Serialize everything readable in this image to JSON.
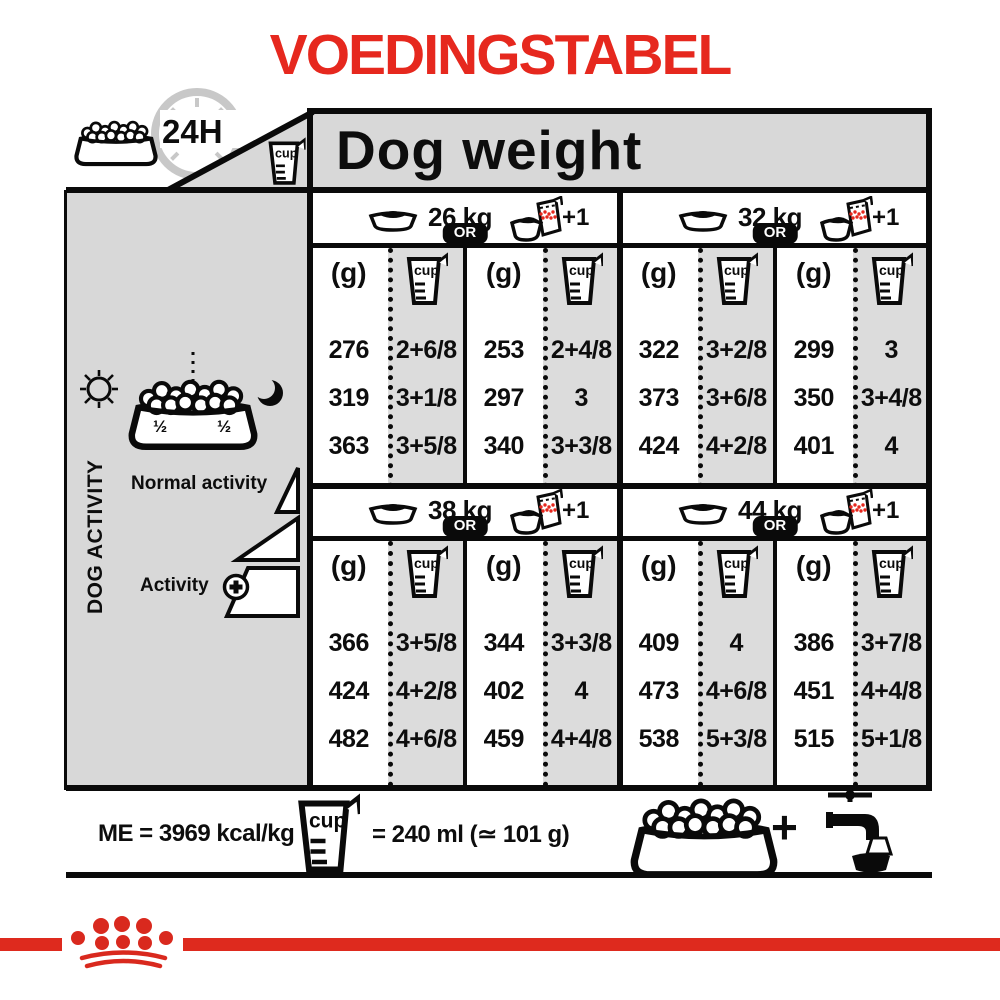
{
  "title": "VOEDINGSTABEL",
  "top": {
    "duration_label": "24H"
  },
  "header": {
    "title": "Dog weight"
  },
  "labels": {
    "cup": "cup",
    "unit_g": "(g)",
    "or": "OR",
    "plus_one": "+1"
  },
  "sidebar": {
    "axis_label": "DOG ACTIVITY",
    "normal_label": "Normal activity",
    "active_label": "Activity",
    "half_left": "½",
    "half_right": "½"
  },
  "sections": [
    {
      "weight": "26 kg",
      "rows": [
        [
          "276",
          "2+6/8",
          "253",
          "2+4/8"
        ],
        [
          "319",
          "3+1/8",
          "297",
          "3"
        ],
        [
          "363",
          "3+5/8",
          "340",
          "3+3/8"
        ]
      ]
    },
    {
      "weight": "32 kg",
      "rows": [
        [
          "322",
          "3+2/8",
          "299",
          "3"
        ],
        [
          "373",
          "3+6/8",
          "350",
          "3+4/8"
        ],
        [
          "424",
          "4+2/8",
          "401",
          "4"
        ]
      ]
    },
    {
      "weight": "38 kg",
      "rows": [
        [
          "366",
          "3+5/8",
          "344",
          "3+3/8"
        ],
        [
          "424",
          "4+2/8",
          "402",
          "4"
        ],
        [
          "482",
          "4+6/8",
          "459",
          "4+4/8"
        ]
      ]
    },
    {
      "weight": "44 kg",
      "rows": [
        [
          "409",
          "4",
          "386",
          "3+7/8"
        ],
        [
          "473",
          "4+6/8",
          "451",
          "4+4/8"
        ],
        [
          "538",
          "5+3/8",
          "515",
          "5+1/8"
        ]
      ]
    }
  ],
  "footer": {
    "energy": "ME = 3969 kcal/kg",
    "cup_equiv": "= 240 ml (≃ 101 g)",
    "plus": "+"
  },
  "colors": {
    "title_red": "#e6281e",
    "band_red": "#de2a1e",
    "panel_gray": "#d8d8d8",
    "cup_column_gray": "#dcdcdc",
    "ink": "#0a0a0a"
  }
}
